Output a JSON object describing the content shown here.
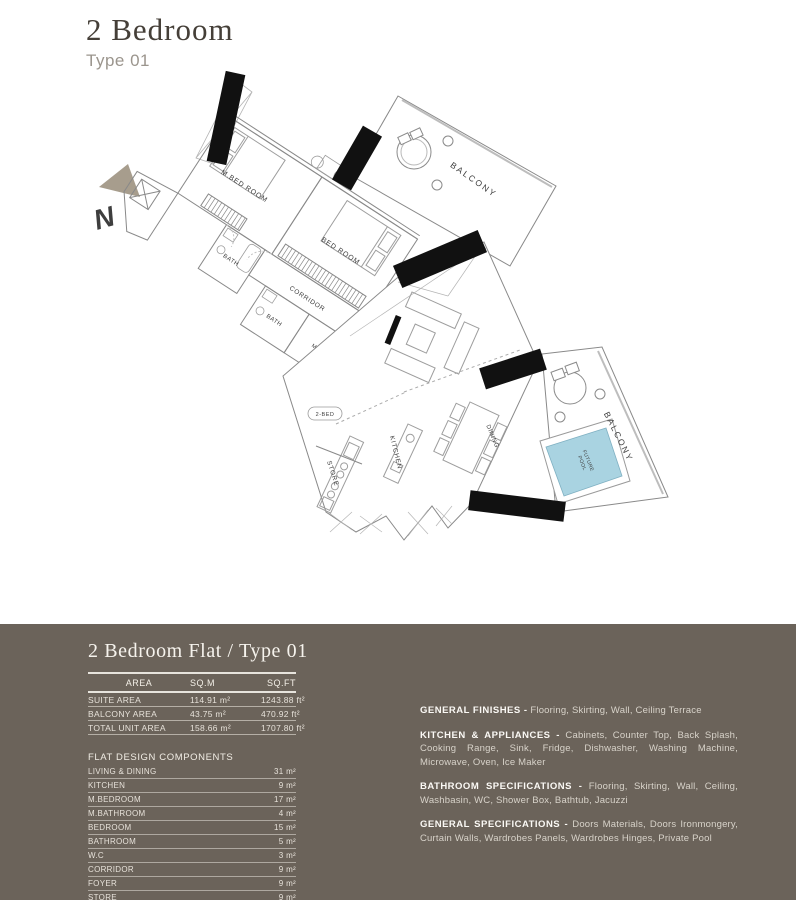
{
  "header": {
    "title": "2 Bedroom",
    "subtitle": "Type 01"
  },
  "compass": {
    "label": "N"
  },
  "plan": {
    "labels": {
      "m_bedroom": "M.BED ROOM",
      "bedroom": "BED ROOM",
      "bath_1": "BATH",
      "bath_2": "BATH",
      "corridor": "CORRIDOR",
      "mc": "M.C",
      "unit_tag": "2-BED",
      "kitchen": "KITCHEN",
      "dining": "DINING",
      "store": "STORE",
      "balcony_top": "BALCONY",
      "balcony_bottom": "BALCONY",
      "future_pool_line1": "FUTURE",
      "future_pool_line2": "POOL"
    },
    "colors": {
      "pool": "#a9d3e1",
      "structure": "#111111",
      "wall_line": "#8a8a8a"
    }
  },
  "panel": {
    "title": "2 Bedroom Flat / Type 01",
    "area_table": {
      "headers": [
        "AREA",
        "SQ.M",
        "SQ.FT"
      ],
      "rows": [
        {
          "label": "SUITE AREA",
          "sqm": "114.91 m²",
          "sqft": "1243.88 ft²"
        },
        {
          "label": "BALCONY AREA",
          "sqm": "43.75 m²",
          "sqft": "470.92 ft²"
        },
        {
          "label": "TOTAL UNIT AREA",
          "sqm": "158.66 m²",
          "sqft": "1707.80 ft²"
        }
      ]
    },
    "components": {
      "title": "FLAT DESIGN COMPONENTS",
      "rows": [
        {
          "label": "LIVING & DINING",
          "value": "31 m²"
        },
        {
          "label": "KITCHEN",
          "value": "9 m²"
        },
        {
          "label": "M.BEDROOM",
          "value": "17 m²"
        },
        {
          "label": "M.BATHROOM",
          "value": "4 m²"
        },
        {
          "label": "BEDROOM",
          "value": "15 m²"
        },
        {
          "label": "BATHROOM",
          "value": "5 m²"
        },
        {
          "label": "W.C",
          "value": "3 m²"
        },
        {
          "label": "CORRIDOR",
          "value": "9 m²"
        },
        {
          "label": "FOYER",
          "value": "9 m²"
        },
        {
          "label": "STORE",
          "value": "9 m²"
        }
      ]
    },
    "specs": [
      {
        "heading": "GENERAL FINISHES -",
        "text": "Flooring, Skirting, Wall, Ceiling Terrace"
      },
      {
        "heading": "KITCHEN & APPLIANCES -",
        "text": "Cabinets, Counter Top, Back Splash, Cooking Range, Sink, Fridge, Dishwasher, Washing Machine, Microwave, Oven, Ice Maker"
      },
      {
        "heading": "BATHROOM SPECIFICATIONS -",
        "text": "Flooring, Skirting, Wall, Ceiling, Washbasin, WC, Shower Box, Bathtub, Jacuzzi"
      },
      {
        "heading": "GENERAL SPECIFICATIONS -",
        "text": "Doors Materials, Doors Ironmongery, Curtain Walls, Wardrobes Panels, Wardrobes Hinges, Private Pool"
      }
    ]
  }
}
